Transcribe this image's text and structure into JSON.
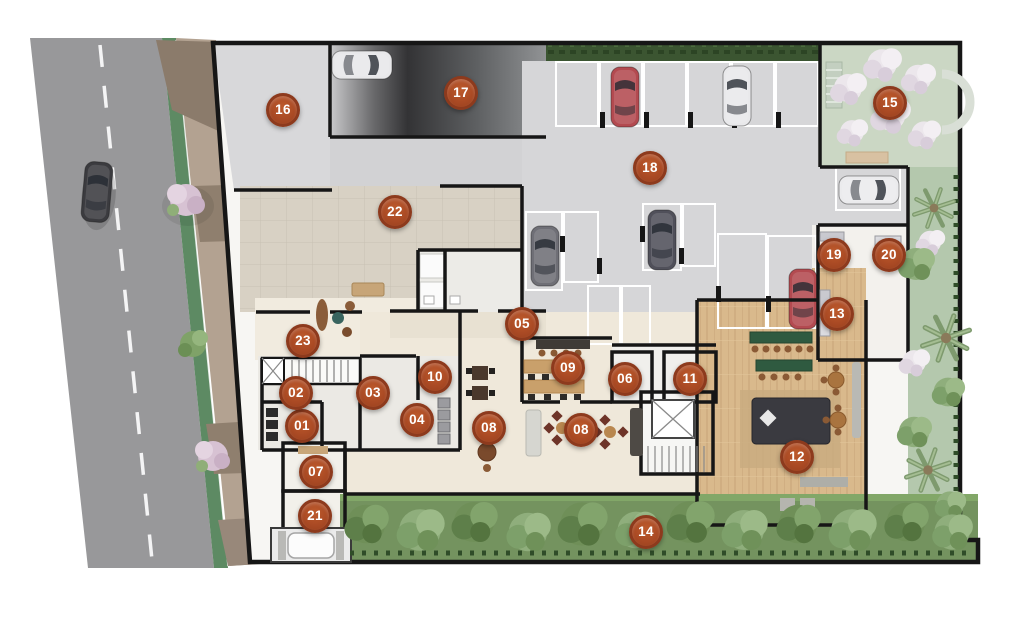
{
  "plan": {
    "title": "residential-ground-floor-site-plan",
    "marker_style": {
      "fill": "#aa4a24",
      "ring": "#8d3a1d",
      "text_color": "#ffffff"
    },
    "markers": [
      {
        "num": "01",
        "x": 302,
        "y": 426
      },
      {
        "num": "02",
        "x": 296,
        "y": 393
      },
      {
        "num": "03",
        "x": 373,
        "y": 393
      },
      {
        "num": "04",
        "x": 417,
        "y": 420
      },
      {
        "num": "05",
        "x": 522,
        "y": 324
      },
      {
        "num": "06",
        "x": 625,
        "y": 379
      },
      {
        "num": "07",
        "x": 316,
        "y": 472
      },
      {
        "num": "08",
        "x": 489,
        "y": 428
      },
      {
        "num": "08",
        "x": 581,
        "y": 430
      },
      {
        "num": "09",
        "x": 568,
        "y": 368
      },
      {
        "num": "10",
        "x": 435,
        "y": 377
      },
      {
        "num": "11",
        "x": 690,
        "y": 379
      },
      {
        "num": "12",
        "x": 797,
        "y": 457
      },
      {
        "num": "13",
        "x": 837,
        "y": 314
      },
      {
        "num": "14",
        "x": 646,
        "y": 532
      },
      {
        "num": "15",
        "x": 890,
        "y": 103
      },
      {
        "num": "16",
        "x": 283,
        "y": 110
      },
      {
        "num": "17",
        "x": 461,
        "y": 93
      },
      {
        "num": "18",
        "x": 650,
        "y": 168
      },
      {
        "num": "19",
        "x": 834,
        "y": 255
      },
      {
        "num": "20",
        "x": 889,
        "y": 255
      },
      {
        "num": "21",
        "x": 315,
        "y": 516
      },
      {
        "num": "22",
        "x": 395,
        "y": 212
      },
      {
        "num": "23",
        "x": 303,
        "y": 341
      }
    ]
  },
  "palette": {
    "road": "#98989a",
    "curb_green": "#5d8a63",
    "sidewalk": "#b3a291",
    "sidewalk_dark": "#8b7b6b",
    "parking_floor": "#d6d6d8",
    "ramp_dark": "#303032",
    "tile_beige": "#d8d1c4",
    "interior_cream": "#efe8da",
    "wood_deck": "#d9b98c",
    "garden_light": "#cbd7c4",
    "garden_mid": "#b4c8ad",
    "garden_dark": "#74935f",
    "grass_strip": "#3b5531",
    "wall": "#161616",
    "stall_line": "#ffffff",
    "car_red": "#b34a50",
    "car_white": "#e9e9eb",
    "car_gray": "#6f6f76",
    "car_dark": "#50505a"
  }
}
